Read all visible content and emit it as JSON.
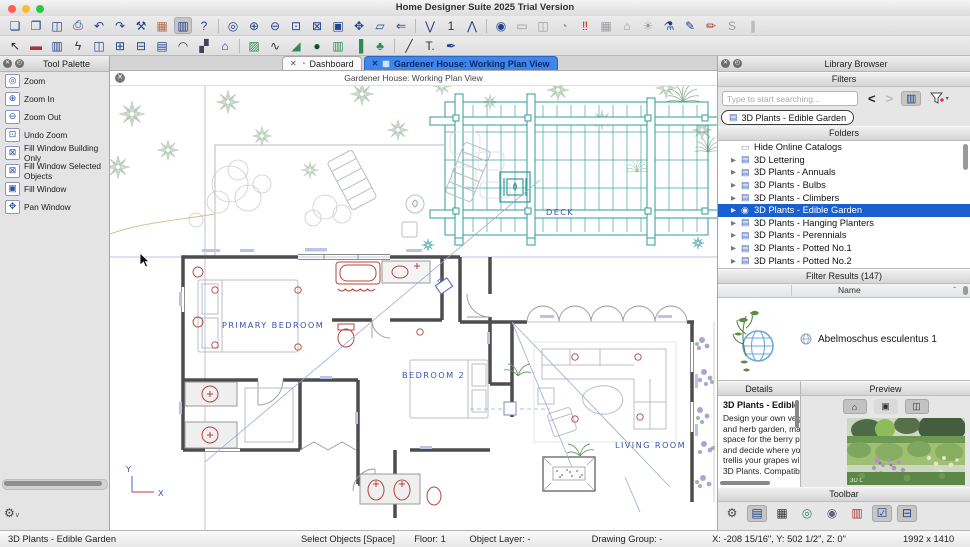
{
  "window": {
    "title": "Home Designer Suite 2025 Trial Version",
    "traffic_lights": [
      "#ff5f57",
      "#febc2e",
      "#28c840"
    ]
  },
  "toolbar_main": {
    "items": [
      {
        "name": "new-document",
        "glyph": "❏"
      },
      {
        "name": "open-folder",
        "glyph": "❐"
      },
      {
        "name": "save",
        "glyph": "◫"
      },
      {
        "name": "print",
        "glyph": "⎙"
      },
      {
        "name": "undo",
        "glyph": "↶"
      },
      {
        "name": "redo",
        "glyph": "↷"
      },
      {
        "name": "settings-wrench",
        "glyph": "⚒"
      },
      {
        "name": "layout-panels",
        "glyph": "▦",
        "color": "#b06a4a"
      },
      {
        "name": "library-browser",
        "glyph": "▥",
        "pressed": true
      },
      {
        "name": "help",
        "glyph": "?"
      },
      {
        "sep": true
      },
      {
        "name": "zoom",
        "glyph": "◎"
      },
      {
        "name": "zoom-in",
        "glyph": "⊕"
      },
      {
        "name": "zoom-out",
        "glyph": "⊖"
      },
      {
        "name": "undo-zoom",
        "glyph": "⊡"
      },
      {
        "name": "fill-window-building-only",
        "glyph": "⊠"
      },
      {
        "name": "fill-window",
        "glyph": "▣"
      },
      {
        "name": "pan-window",
        "glyph": "✥"
      },
      {
        "name": "layers-3d",
        "glyph": "▱"
      },
      {
        "name": "back-reference",
        "glyph": "⇐"
      },
      {
        "sep": true
      },
      {
        "name": "floor-down",
        "glyph": "⋁"
      },
      {
        "name": "floor-number",
        "glyph": "1",
        "color": "#333"
      },
      {
        "name": "floor-up",
        "glyph": "⋀"
      },
      {
        "sep": true
      },
      {
        "name": "camera-view",
        "glyph": "◉"
      },
      {
        "name": "render-view",
        "glyph": "▭",
        "color": "#9a9aa2"
      },
      {
        "name": "snapshot",
        "glyph": "◫",
        "color": "#9a9aa2"
      },
      {
        "name": "record-walkthrough",
        "glyph": "◔",
        "color": "#9a9aa2"
      },
      {
        "name": "walkthrough-footprints",
        "glyph": "‼",
        "color": "#c22"
      },
      {
        "name": "building-overview",
        "glyph": "▦",
        "color": "#9a9aa2"
      },
      {
        "name": "home-overview",
        "glyph": "⌂",
        "color": "#9a9aa2"
      },
      {
        "name": "lighting",
        "glyph": "☀",
        "color": "#9a9aa2"
      },
      {
        "name": "spray-can",
        "glyph": "⚗"
      },
      {
        "name": "eyedropper",
        "glyph": "✎"
      },
      {
        "name": "style-painter",
        "glyph": "✏",
        "color": "#b03030"
      },
      {
        "name": "adjust-style",
        "glyph": "S",
        "color": "#9a9aa2"
      },
      {
        "name": "match-properties",
        "glyph": "∥",
        "color": "#9a9aa2"
      }
    ]
  },
  "toolbar_build": {
    "items": [
      {
        "name": "select-objects",
        "glyph": "↖",
        "color": "#222"
      },
      {
        "name": "wall-tool",
        "glyph": "▬",
        "color": "#a33"
      },
      {
        "name": "railing-tool",
        "glyph": "▥"
      },
      {
        "name": "electrical-tool",
        "glyph": "ϟ",
        "color": "#333"
      },
      {
        "name": "door-tool",
        "glyph": "◫"
      },
      {
        "name": "window-tool",
        "glyph": "⊞"
      },
      {
        "name": "sliding-door-tool",
        "glyph": "⊟"
      },
      {
        "name": "cabinet-tool",
        "glyph": "▤"
      },
      {
        "name": "roof-tool",
        "glyph": "◠",
        "color": "#445"
      },
      {
        "name": "dormer-tool",
        "glyph": "▞",
        "color": "#445"
      },
      {
        "name": "house-tool",
        "glyph": "⌂"
      },
      {
        "sep": true
      },
      {
        "name": "terrain-hatch-tool",
        "glyph": "▨",
        "color": "#2e8b57"
      },
      {
        "name": "spline-tool",
        "glyph": "∿",
        "color": "#333"
      },
      {
        "name": "terrain-tool",
        "glyph": "◢",
        "color": "#2e8b57"
      },
      {
        "name": "pond-tool",
        "glyph": "●",
        "color": "#14502e"
      },
      {
        "name": "deck-tool",
        "glyph": "▥",
        "color": "#2e8b57"
      },
      {
        "name": "gate-tool",
        "glyph": "▐",
        "color": "#2e8b57"
      },
      {
        "name": "tree-tool",
        "glyph": "♣",
        "color": "#2e8b57"
      },
      {
        "sep": true
      },
      {
        "name": "line-tool",
        "glyph": "╱",
        "color": "#333"
      },
      {
        "name": "text-tool",
        "glyph": "T.",
        "color": "#333"
      },
      {
        "name": "paint-tool",
        "glyph": "✒"
      }
    ]
  },
  "tool_palette": {
    "title": "Tool Palette",
    "items": [
      {
        "name": "zoom",
        "glyph": "◎",
        "label": "Zoom"
      },
      {
        "name": "zoom-in",
        "glyph": "⊕",
        "label": "Zoom In"
      },
      {
        "name": "zoom-out",
        "glyph": "⊖",
        "label": "Zoom Out"
      },
      {
        "name": "undo-zoom",
        "glyph": "⊡",
        "label": "Undo Zoom"
      },
      {
        "name": "fill-window-building-only",
        "glyph": "⊠",
        "label": "Fill Window Building Only"
      },
      {
        "name": "fill-window-selected-objects",
        "glyph": "⊠",
        "label": "Fill Window Selected Objects"
      },
      {
        "name": "fill-window",
        "glyph": "▣",
        "label": "Fill Window"
      },
      {
        "name": "pan-window",
        "glyph": "✥",
        "label": "Pan Window"
      }
    ]
  },
  "tabs": [
    {
      "label": "Dashboard",
      "selected": false
    },
    {
      "label": "Gardener House:  Working Plan View",
      "selected": true
    }
  ],
  "view_title": "Gardener House:  Working Plan View",
  "plan": {
    "labels": {
      "deck": "DECK",
      "primary_bedroom": "PRIMARY BEDROOM",
      "bedroom2": "BEDROOM 2",
      "living_room": "LIVING ROOM",
      "axis_x": "X",
      "axis_y": "Y"
    }
  },
  "library": {
    "title": "Library Browser",
    "sections": {
      "filters": "Filters",
      "folders": "Folders",
      "results": "Filter Results (147)",
      "name_col": "Name",
      "details": "Details",
      "preview": "Preview",
      "toolbar": "Toolbar"
    },
    "search_placeholder": "Type to start searching...",
    "chip": "3D Plants - Edible Garden",
    "folders": [
      {
        "label": "Hide Online Catalogs",
        "icon": "catalog",
        "arrow": false,
        "selected": false
      },
      {
        "label": "3D Lettering",
        "icon": "folder",
        "arrow": true,
        "selected": false
      },
      {
        "label": "3D Plants - Annuals",
        "icon": "folder",
        "arrow": true,
        "selected": false
      },
      {
        "label": "3D Plants - Bulbs",
        "icon": "folder",
        "arrow": true,
        "selected": false
      },
      {
        "label": "3D Plants - Climbers",
        "icon": "folder",
        "arrow": true,
        "selected": false
      },
      {
        "label": "3D Plants - Edible Garden",
        "icon": "globe",
        "arrow": true,
        "selected": true
      },
      {
        "label": "3D Plants - Hanging Planters",
        "icon": "folder",
        "arrow": true,
        "selected": false
      },
      {
        "label": "3D Plants - Perennials",
        "icon": "folder",
        "arrow": true,
        "selected": false
      },
      {
        "label": "3D Plants - Potted No.1",
        "icon": "folder",
        "arrow": true,
        "selected": false
      },
      {
        "label": "3D Plants - Potted No.2",
        "icon": "folder",
        "arrow": true,
        "selected": false
      }
    ],
    "result_item": {
      "name": "Abelmoschus esculentus 1"
    },
    "details": {
      "title": "3D Plants - Edible G",
      "lines": [
        "Design your own veg",
        "and herb garden, ma",
        "space for the berry p",
        "and decide where yo",
        "trellis your grapes wi",
        "3D Plants. Compatib"
      ]
    },
    "preview_buttons": [
      {
        "name": "placement-options",
        "glyph": "⌂",
        "pressed": true
      },
      {
        "name": "fill-preview",
        "glyph": "▣",
        "pressed": false
      },
      {
        "name": "toggle-preview-panel",
        "glyph": "◫",
        "pressed": true
      }
    ],
    "preview_watermark": "3D L",
    "toolbar_icons": [
      {
        "name": "library-settings-gear",
        "glyph": "⚙",
        "color": "#444"
      },
      {
        "name": "view-list",
        "glyph": "▤",
        "pressed": true,
        "color": "#23418c"
      },
      {
        "name": "view-grid",
        "glyph": "▦",
        "color": "#333"
      },
      {
        "name": "plant-chooser",
        "glyph": "◎",
        "color": "#2e8b57"
      },
      {
        "name": "core-catalogs-globe",
        "glyph": "◉",
        "color": "#667"
      },
      {
        "name": "library-panels",
        "glyph": "▥",
        "color": "#a33"
      },
      {
        "name": "expand-tree-check",
        "glyph": "☑",
        "pressed": true,
        "color": "#23418c"
      },
      {
        "name": "folder-options",
        "glyph": "⊟",
        "pressed": true,
        "color": "#23418c"
      }
    ]
  },
  "statusbar": {
    "fields": [
      {
        "name": "active-filter",
        "label": "3D Plants - Edible Garden",
        "x": 8,
        "center": false
      },
      {
        "name": "active-tool",
        "label": "Select Objects [Space]",
        "x": 348,
        "center": true
      },
      {
        "name": "floor",
        "label": "Floor: 1",
        "x": 430,
        "center": true
      },
      {
        "name": "object-layer",
        "label": "Object Layer: -",
        "x": 500,
        "center": true
      },
      {
        "name": "drawing-group",
        "label": "Drawing Group: -",
        "x": 627,
        "center": true
      },
      {
        "name": "coordinates",
        "label": "X: -208 15/16\", Y: 502 1/2\", Z: 0\"",
        "x": 779,
        "center": true
      },
      {
        "name": "plan-size",
        "label": "1992 x 1410",
        "x": 903,
        "center": false
      }
    ]
  },
  "colors": {
    "accent_blue": "#3f86ec",
    "selection_blue": "#1a5fd0",
    "deck_teal": "#2f9b9b",
    "wall_gray": "#4d4d4d",
    "fixture_red": "#b5443c",
    "label_blue": "#3a53b0"
  }
}
